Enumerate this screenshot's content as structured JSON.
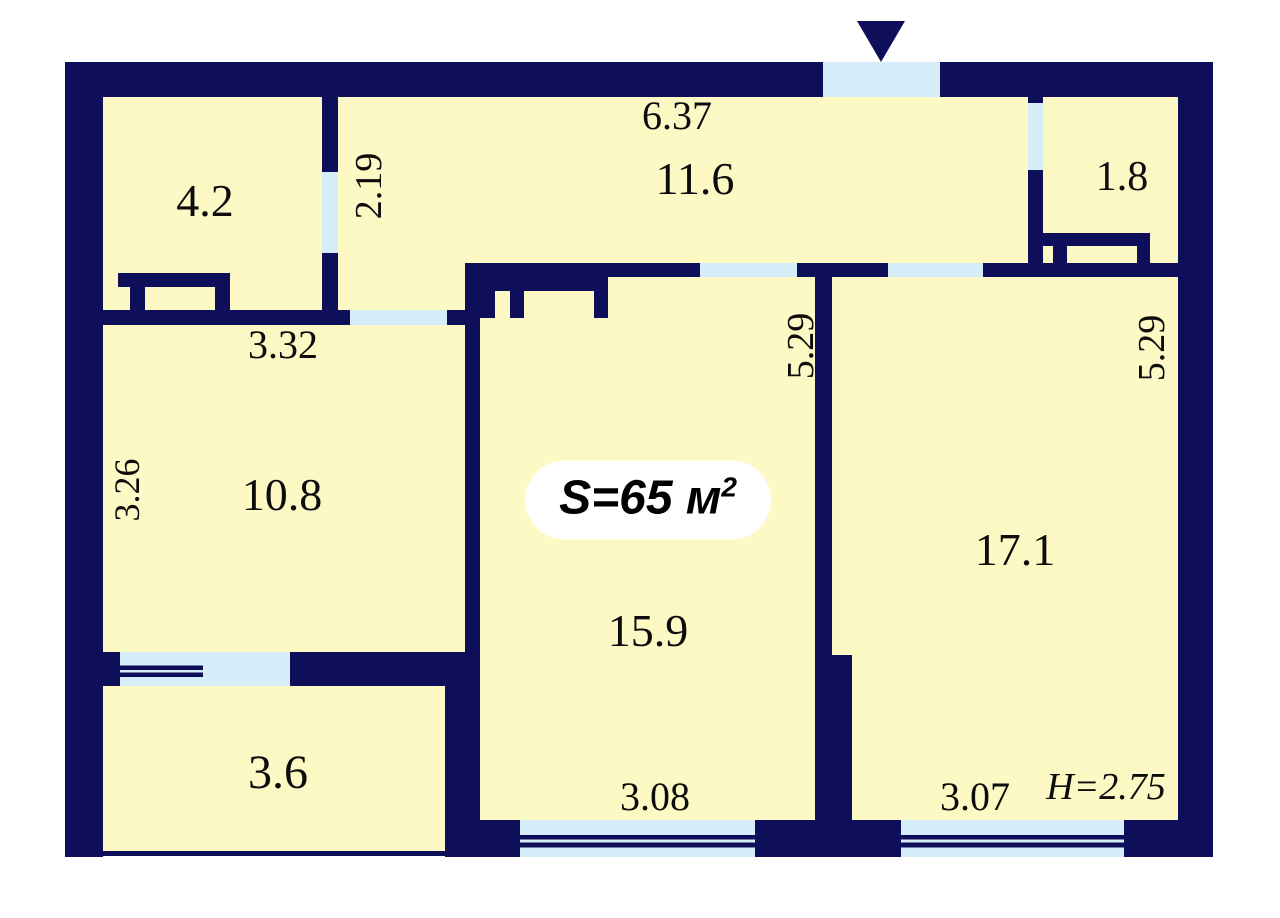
{
  "floorplan": {
    "badge": {
      "area": "S=65 м",
      "sup": "2"
    },
    "ceiling_height": "H=2.75",
    "rooms": {
      "entry_hall": {
        "area": "11.6",
        "width": "6.37",
        "passage_width": "2.19"
      },
      "closet": {
        "area": "1.8"
      },
      "bathroom": {
        "area": "4.2",
        "width": "3.32"
      },
      "kitchen": {
        "area": "10.8",
        "depth": "3.26"
      },
      "living_room": {
        "area": "15.9",
        "depth": "5.29",
        "width": "3.08"
      },
      "bedroom": {
        "area": "17.1",
        "depth": "5.29",
        "width": "3.07"
      },
      "balcony": {
        "area": "3.6"
      }
    },
    "colors": {
      "wall": "#0e0e5a",
      "floor": "#fdf9c5",
      "opening": "#d5ecf9",
      "background": "#ffffff",
      "label": "#0d0d0d"
    }
  }
}
